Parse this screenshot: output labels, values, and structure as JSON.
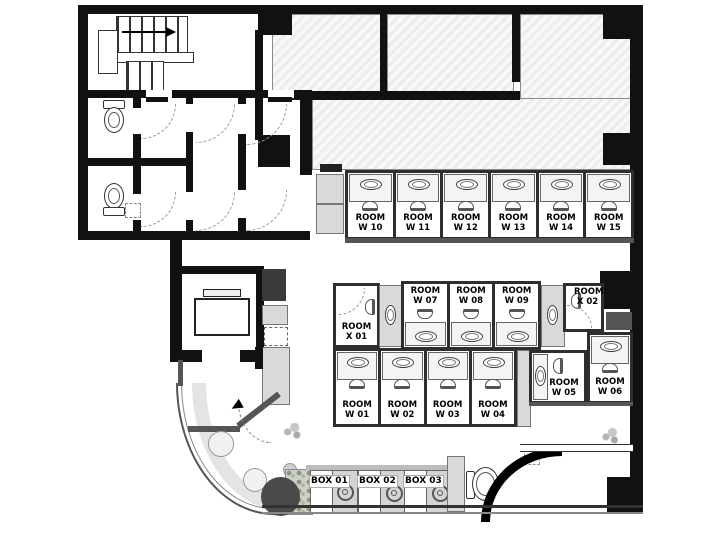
{
  "plan": {
    "rooms_top": [
      {
        "l1": "ROOM",
        "l2": "W 10"
      },
      {
        "l1": "ROOM",
        "l2": "W 11"
      },
      {
        "l1": "ROOM",
        "l2": "W 12"
      },
      {
        "l1": "ROOM",
        "l2": "W 13"
      },
      {
        "l1": "ROOM",
        "l2": "W 14"
      },
      {
        "l1": "ROOM",
        "l2": "W 15"
      }
    ],
    "rooms_mid": [
      {
        "l1": "ROOM",
        "l2": "W 07"
      },
      {
        "l1": "ROOM",
        "l2": "W 08"
      },
      {
        "l1": "ROOM",
        "l2": "W 09"
      }
    ],
    "rooms_bottom": [
      {
        "l1": "ROOM",
        "l2": "W 01"
      },
      {
        "l1": "ROOM",
        "l2": "W 02"
      },
      {
        "l1": "ROOM",
        "l2": "W 03"
      },
      {
        "l1": "ROOM",
        "l2": "W 04"
      }
    ],
    "room_w05": {
      "l1": "ROOM",
      "l2": "W 05"
    },
    "room_w06": {
      "l1": "ROOM",
      "l2": "W 06"
    },
    "room_x01": {
      "l1": "ROOM",
      "l2": "X 01"
    },
    "room_x02": {
      "l1": "ROOM",
      "l2": "X 02"
    },
    "boxes": [
      {
        "label": "BOX 01"
      },
      {
        "label": "BOX 02"
      },
      {
        "label": "BOX 03"
      }
    ],
    "colors": {
      "wall": "#111111",
      "room_divider": "#2e2e2e",
      "fixture_gray": "#d9d9d9",
      "hatch_base": "#ececec",
      "dark_table": "#4a4a4a"
    }
  }
}
